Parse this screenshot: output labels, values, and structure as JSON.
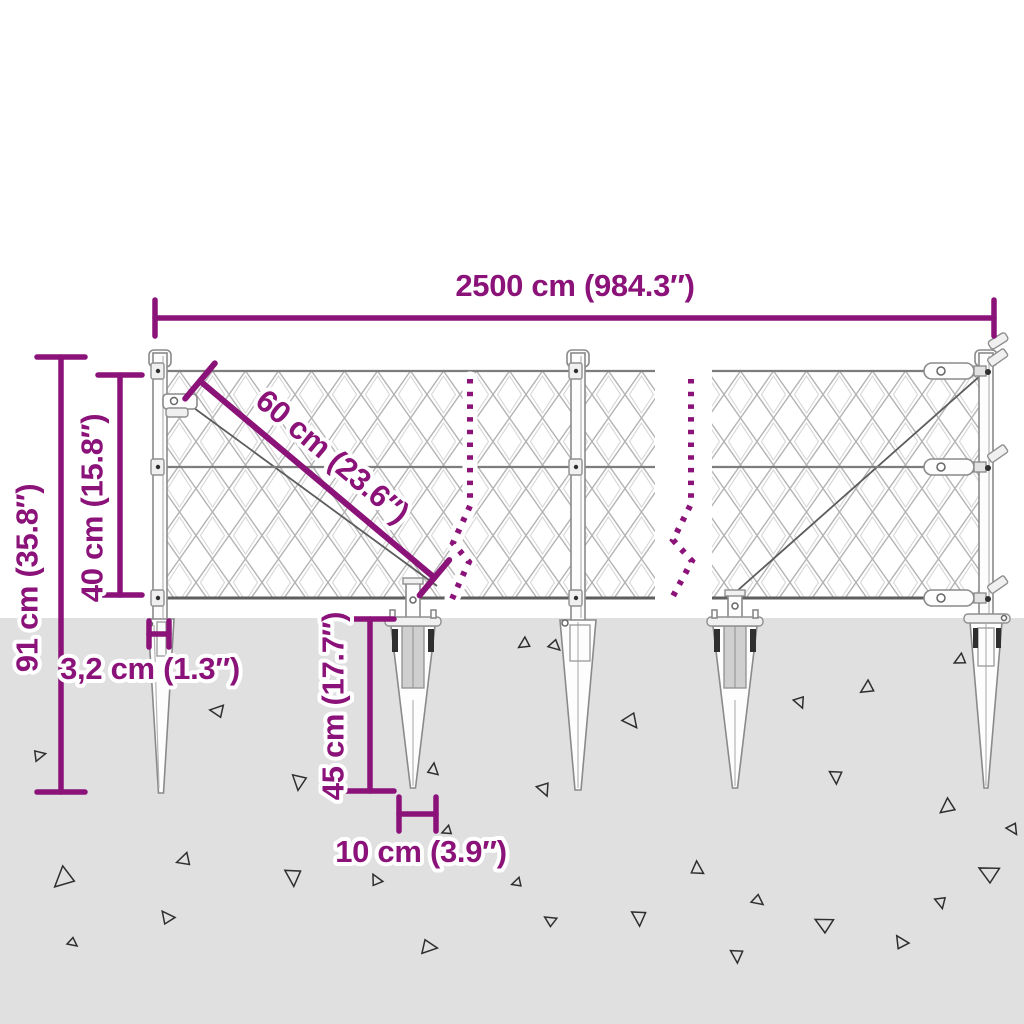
{
  "colors": {
    "accent": "#8A1278",
    "ground": "#E0E0E0",
    "bg": "#FFFFFF"
  },
  "dimensions": {
    "total_width": "2500 cm (984.3″)",
    "total_height": "91 cm (35.8″)",
    "mesh_height": "40 cm (15.8″)",
    "mesh_diagonal": "60 cm (23.6″)",
    "post_width": "3,2 cm (1.3″)",
    "spike_depth": "45 cm (17.7″)",
    "spike_base_width": "10 cm (3.9″)"
  },
  "ground": {
    "triangles": [
      [
        39,
        756,
        6,
        200
      ],
      [
        218,
        710,
        7,
        40
      ],
      [
        298,
        781,
        8,
        310
      ],
      [
        434,
        770,
        6,
        130
      ],
      [
        184,
        859,
        7,
        15
      ],
      [
        63,
        877,
        11,
        350
      ],
      [
        292,
        876,
        9,
        300
      ],
      [
        377,
        880,
        6,
        95
      ],
      [
        447,
        830,
        5,
        10
      ],
      [
        428,
        948,
        8,
        220
      ],
      [
        168,
        917,
        7,
        85
      ],
      [
        72,
        943,
        5,
        250
      ],
      [
        524,
        643,
        6,
        0
      ],
      [
        554,
        646,
        6,
        255
      ],
      [
        630,
        721,
        8,
        265
      ],
      [
        543,
        789,
        7,
        280
      ],
      [
        638,
        917,
        8,
        300
      ],
      [
        551,
        920,
        6,
        65
      ],
      [
        698,
        869,
        7,
        120
      ],
      [
        736,
        955,
        7,
        300
      ],
      [
        757,
        901,
        6,
        250
      ],
      [
        825,
        923,
        9,
        60
      ],
      [
        835,
        776,
        7,
        300
      ],
      [
        867,
        687,
        7,
        0
      ],
      [
        799,
        702,
        6,
        280
      ],
      [
        902,
        942,
        7,
        90
      ],
      [
        947,
        806,
        8,
        355
      ],
      [
        940,
        902,
        6,
        290
      ],
      [
        990,
        872,
        10,
        60
      ],
      [
        960,
        659,
        6,
        5
      ],
      [
        1012,
        829,
        6,
        270
      ],
      [
        517,
        882,
        5,
        15
      ]
    ]
  }
}
